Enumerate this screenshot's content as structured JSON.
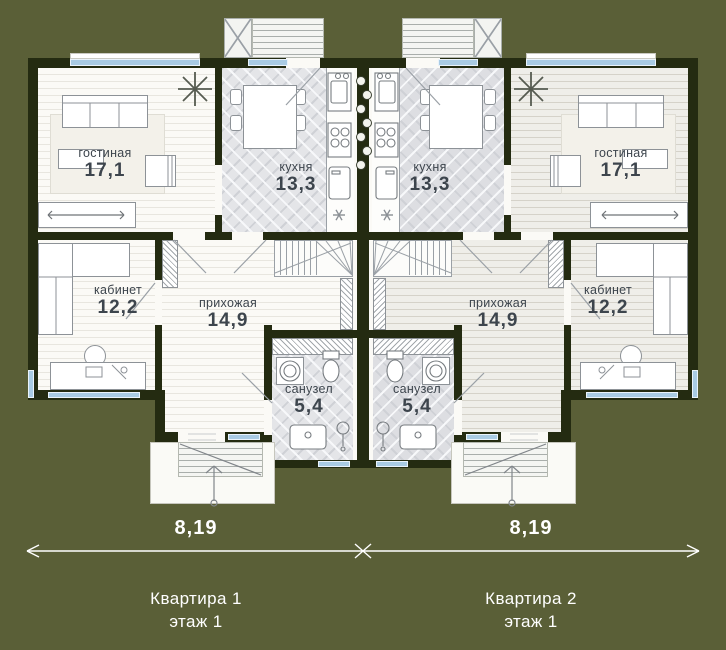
{
  "colors": {
    "background": "#5a5f37",
    "wall": "#242b11",
    "window": "#a9cbe4",
    "floor_apartment1": "#fbfaf6",
    "floor_apartment2": "#efeee9",
    "kitchen_tile": "#e4e5e8",
    "room_label_text": "#3d454d",
    "annotation_text": "#ffffff"
  },
  "apartments": [
    {
      "name": "Квартира 1",
      "floor_label": "этаж 1",
      "dimension": "8,19",
      "rooms": {
        "living": {
          "label": "гостиная",
          "area": "17,1"
        },
        "kitchen": {
          "label": "кухня",
          "area": "13,3"
        },
        "office": {
          "label": "кабинет",
          "area": "12,2"
        },
        "hall": {
          "label": "прихожая",
          "area": "14,9"
        },
        "bath": {
          "label": "санузел",
          "area": "5,4"
        }
      }
    },
    {
      "name": "Квартира 2",
      "floor_label": "этаж 1",
      "dimension": "8,19",
      "rooms": {
        "living": {
          "label": "гостиная",
          "area": "17,1"
        },
        "kitchen": {
          "label": "кухня",
          "area": "13,3"
        },
        "office": {
          "label": "кабинет",
          "area": "12,2"
        },
        "hall": {
          "label": "прихожая",
          "area": "14,9"
        },
        "bath": {
          "label": "санузел",
          "area": "5,4"
        }
      }
    }
  ]
}
